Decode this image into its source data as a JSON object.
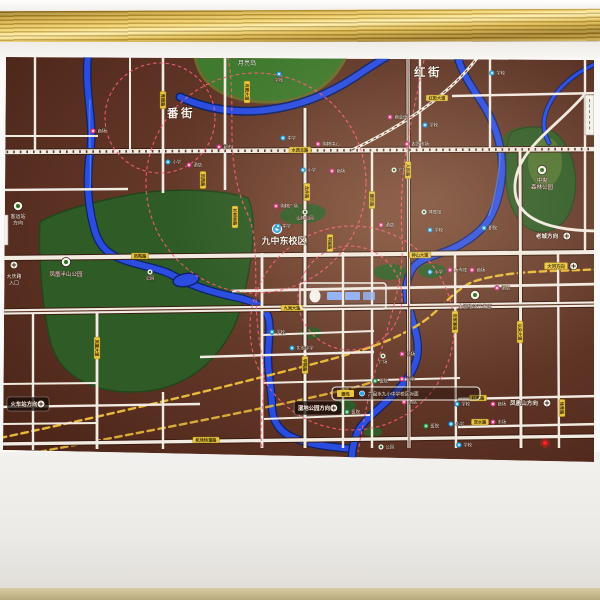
{
  "photo": {
    "subject": "real-estate district map mounted on a wall beneath a gold picture molding"
  },
  "colors": {
    "map_bg": "#5d3426",
    "map_light": "#7b4a34",
    "road": "#f2ebe2",
    "road_casing": "#3a1c10",
    "river": "#2a4de0",
    "river_edge": "#0e2266",
    "river_gloss": "#5b82f5",
    "park": "#2f5c26",
    "park_dark": "#33551f",
    "island": "#3f7a2e",
    "shore": "#6b6b2c",
    "ring": "#ff5d7a",
    "railway": "#e8b93a",
    "label_bg": "#e9c83f",
    "label_text": "#3c2a08",
    "school": "#2fa8e8",
    "mall": "#e8468c",
    "hospital": "#2f9e4f",
    "text_light": "#f7f3ea",
    "gold_frame": "#c9a43c",
    "red_light": "#ff2020"
  },
  "districts": [
    {
      "text": "番街",
      "x": 181,
      "y": 117
    },
    {
      "text": "红街",
      "x": 428,
      "y": 76
    }
  ],
  "island_label": {
    "text": "月亮岛",
    "x": 247,
    "y": 65
  },
  "landmarks": [
    {
      "id": "jiuzhong-east-campus",
      "icon": "school",
      "ix": 277,
      "iy": 229,
      "lines": [
        "九中东校区"
      ],
      "x": 284,
      "y": 244,
      "size": 9,
      "bold": true
    },
    {
      "id": "central-forest-park",
      "icon": "park",
      "ix": 542,
      "iy": 170,
      "lines": [
        "中央",
        "森林公园"
      ],
      "x": 542,
      "y": 182,
      "size": 5.5
    },
    {
      "id": "fenghuang-hillside-park",
      "icon": "park",
      "ix": 66,
      "iy": 262,
      "lines": [
        "凤凰半山公园"
      ],
      "x": 66,
      "y": 276,
      "size": 5.5
    },
    {
      "id": "daqing-road-entrance",
      "icon": "compass",
      "ix": 14,
      "iy": 265,
      "lines": [
        "大庆路",
        "入口"
      ],
      "x": 14,
      "y": 278,
      "size": 5
    },
    {
      "id": "dahe-economic-zone",
      "icon": "park",
      "ix": 475,
      "iy": 295,
      "lines": [
        "大河经济开发区"
      ],
      "x": 475,
      "y": 308,
      "size": 4.8
    },
    {
      "id": "coach-station",
      "icon": "park",
      "ix": 18,
      "iy": 206,
      "lines": [
        "客运站",
        "方向"
      ],
      "x": 18,
      "y": 218,
      "size": 5
    }
  ],
  "markers": [
    {
      "x": 279,
      "y": 74,
      "t": "school",
      "l": "学校",
      "lp": "b"
    },
    {
      "x": 492,
      "y": 73,
      "t": "school",
      "l": "学校"
    },
    {
      "x": 93,
      "y": 131,
      "t": "mall",
      "l": "商场"
    },
    {
      "x": 219,
      "y": 147,
      "t": "mall",
      "l": "超市"
    },
    {
      "x": 168,
      "y": 162,
      "t": "school",
      "l": "小学"
    },
    {
      "x": 189,
      "y": 165,
      "t": "mall",
      "l": "酒店"
    },
    {
      "x": 283,
      "y": 138,
      "t": "school",
      "l": "中学"
    },
    {
      "x": 318,
      "y": 144,
      "t": "mall",
      "l": "购物中心"
    },
    {
      "x": 390,
      "y": 117,
      "t": "mall",
      "l": "商业街"
    },
    {
      "x": 425,
      "y": 125,
      "t": "school",
      "l": "学校"
    },
    {
      "x": 407,
      "y": 144,
      "t": "mall",
      "l": "农贸市场"
    },
    {
      "x": 303,
      "y": 170,
      "t": "school",
      "l": "小学"
    },
    {
      "x": 332,
      "y": 171,
      "t": "mall",
      "l": "商场"
    },
    {
      "x": 394,
      "y": 170,
      "t": "park",
      "l": "广场"
    },
    {
      "x": 276,
      "y": 206,
      "t": "mall",
      "l": "购物广场"
    },
    {
      "x": 278,
      "y": 226,
      "t": "school",
      "l": "中学"
    },
    {
      "x": 305,
      "y": 212,
      "t": "park",
      "l": "山体公园",
      "lp": "b"
    },
    {
      "x": 381,
      "y": 225,
      "t": "mall",
      "l": "酒店"
    },
    {
      "x": 424,
      "y": 212,
      "t": "park",
      "l": "体育馆"
    },
    {
      "x": 430,
      "y": 230,
      "t": "school",
      "l": "学校"
    },
    {
      "x": 484,
      "y": 228,
      "t": "school",
      "l": "职院"
    },
    {
      "x": 450,
      "y": 270,
      "t": "mall",
      "l": "大车库"
    },
    {
      "x": 472,
      "y": 270,
      "t": "mall",
      "l": "商场"
    },
    {
      "x": 430,
      "y": 272,
      "t": "school",
      "l": "小学"
    },
    {
      "x": 497,
      "y": 288,
      "t": "mall",
      "l": "酒店"
    },
    {
      "x": 272,
      "y": 332,
      "t": "school",
      "l": "学校"
    },
    {
      "x": 292,
      "y": 348,
      "t": "school",
      "l": "实验小学"
    },
    {
      "x": 383,
      "y": 356,
      "t": "park",
      "l": "广场",
      "lp": "b"
    },
    {
      "x": 402,
      "y": 354,
      "t": "mall",
      "l": "商场"
    },
    {
      "x": 375,
      "y": 381,
      "t": "hosp",
      "l": "医院"
    },
    {
      "x": 402,
      "y": 379,
      "t": "mall",
      "l": "超市"
    },
    {
      "x": 404,
      "y": 402,
      "t": "mall",
      "l": "酒店"
    },
    {
      "x": 457,
      "y": 404,
      "t": "school",
      "l": "学校"
    },
    {
      "x": 493,
      "y": 404,
      "t": "mall",
      "l": "商场"
    },
    {
      "x": 426,
      "y": 426,
      "t": "hosp",
      "l": "医院"
    },
    {
      "x": 451,
      "y": 424,
      "t": "school",
      "l": "小学"
    },
    {
      "x": 493,
      "y": 422,
      "t": "mall",
      "l": "市场"
    },
    {
      "x": 459,
      "y": 445,
      "t": "school",
      "l": "学校"
    },
    {
      "x": 381,
      "y": 447,
      "t": "park",
      "l": "公园"
    },
    {
      "x": 347,
      "y": 412,
      "t": "hosp",
      "l": "医院"
    },
    {
      "x": 150,
      "y": 272,
      "t": "park",
      "l": "公园",
      "lp": "b"
    }
  ],
  "road_labels": [
    {
      "t": "月照大道",
      "x": 247,
      "y": 92,
      "v": true
    },
    {
      "t": "红街大道",
      "x": 437,
      "y": 98,
      "v": false
    },
    {
      "t": "水西北路",
      "x": 300,
      "y": 150,
      "v": false
    },
    {
      "t": "凤西路",
      "x": 203,
      "y": 180,
      "v": true
    },
    {
      "t": "龙井路",
      "x": 307,
      "y": 192,
      "v": true
    },
    {
      "t": "杉树林路",
      "x": 235,
      "y": 217,
      "v": true
    },
    {
      "t": "凤鸣路",
      "x": 140,
      "y": 256,
      "v": false
    },
    {
      "t": "钟山大道",
      "x": 420,
      "y": 255,
      "v": false
    },
    {
      "t": "明湖路",
      "x": 330,
      "y": 243,
      "v": true
    },
    {
      "t": "九洲大道",
      "x": 292,
      "y": 308,
      "v": false
    },
    {
      "t": "凤凰大道",
      "x": 97,
      "y": 348,
      "v": true
    },
    {
      "t": "以朵大道",
      "x": 520,
      "y": 332,
      "v": true
    },
    {
      "t": "安家寨路",
      "x": 455,
      "y": 322,
      "v": true
    },
    {
      "t": "康乐路",
      "x": 372,
      "y": 200,
      "v": true
    },
    {
      "t": "人民路",
      "x": 408,
      "y": 170,
      "v": true
    },
    {
      "t": "育德路",
      "x": 163,
      "y": 100,
      "v": true
    },
    {
      "t": "学院路",
      "x": 305,
      "y": 365,
      "v": true
    },
    {
      "t": "机场快速路",
      "x": 206,
      "y": 440,
      "v": false
    },
    {
      "t": "红岩路",
      "x": 478,
      "y": 398,
      "v": false
    },
    {
      "t": "双水路",
      "x": 480,
      "y": 422,
      "v": false
    },
    {
      "t": "体育路",
      "x": 562,
      "y": 408,
      "v": true
    }
  ],
  "signs": [
    {
      "id": "wetland-park-direction",
      "text": "湿地公园方向",
      "x": 318,
      "y": 408,
      "style": "dark",
      "icon": "compass"
    },
    {
      "id": "fenghuangshan-direction",
      "text": "凤凰山方向",
      "x": 524,
      "y": 403,
      "style": "plain",
      "icon": "compass"
    },
    {
      "id": "laocheng-direction",
      "text": "老城方向",
      "x": 547,
      "y": 236,
      "style": "plain",
      "icon": "compass"
    },
    {
      "id": "dahe-direction",
      "text": "大河方向",
      "x": 556,
      "y": 266,
      "style": "yellow",
      "icon": "compass"
    },
    {
      "id": "railway-station-direction",
      "text": "火车站方向",
      "x": 28,
      "y": 404,
      "style": "dark",
      "icon": "compass"
    }
  ],
  "strip_sign": {
    "chip": "德坞",
    "text": "六盘水九小中学校区对面",
    "x": 332,
    "y": 387,
    "w": 148,
    "h": 13
  },
  "route_shields": [
    {
      "x": 585,
      "y": 95,
      "w": 9,
      "h": 40
    },
    {
      "x": 0,
      "y": 215,
      "w": 8,
      "h": 30
    }
  ],
  "project_logo": {
    "x": 300,
    "y": 283,
    "w": 86,
    "h": 26,
    "text": ""
  }
}
